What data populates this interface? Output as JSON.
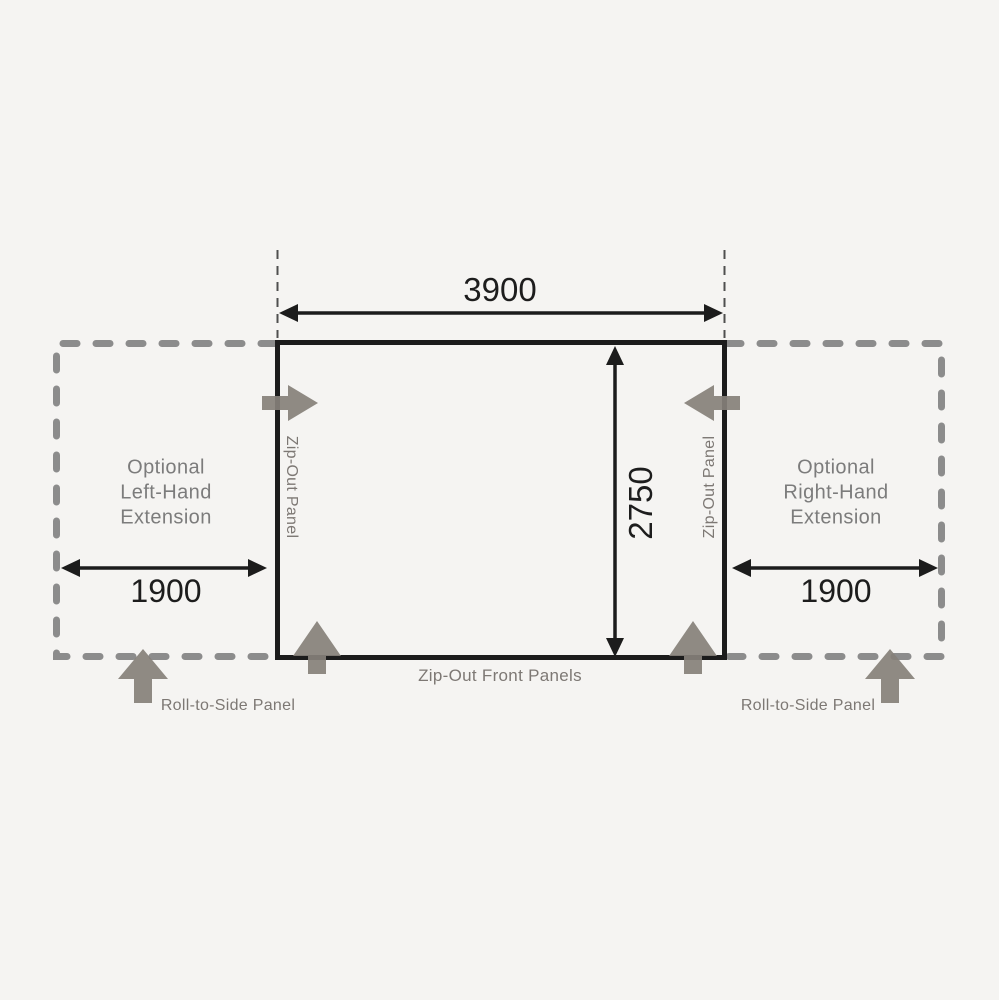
{
  "diagram": {
    "main": {
      "width_mm": "3900",
      "depth_mm": "2750",
      "left_zip_label": "Zip-Out Panel",
      "right_zip_label": "Zip-Out Panel",
      "front_label": "Zip-Out Front Panels"
    },
    "left_extension": {
      "label": "Optional\nLeft-Hand\nExtension",
      "width_mm": "1900",
      "roll_label": "Roll-to-Side Panel"
    },
    "right_extension": {
      "label": "Optional\nRight-Hand\nExtension",
      "width_mm": "1900",
      "roll_label": "Roll-to-Side Panel"
    },
    "colors": {
      "background": "#f5f4f2",
      "outline": "#1c1c1c",
      "dashed_outline": "#8c8c8c",
      "panel_arrow": "#86807a",
      "muted_text": "#7c7c7c"
    }
  }
}
